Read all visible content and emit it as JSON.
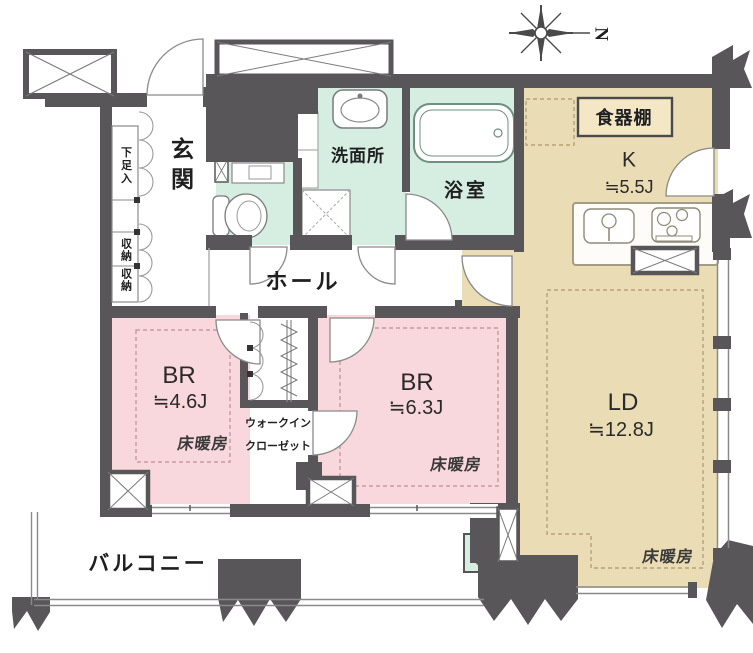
{
  "floor_plan": {
    "compass": {
      "letter": "N"
    },
    "entrance": {
      "label": "玄関",
      "shoe_cabinet": "下足入",
      "storage_upper": "収納",
      "storage_lower": "収納"
    },
    "sanitary": {
      "washroom": "洗面所",
      "bathroom": "浴室"
    },
    "hall": {
      "label": "ホール"
    },
    "kitchen": {
      "label": "K",
      "size": "≒5.5J",
      "cupboard": "食器棚"
    },
    "bedroom1": {
      "label": "BR",
      "size": "≒4.6J",
      "floor_heating": "床暖房"
    },
    "bedroom2": {
      "label": "BR",
      "size": "≒6.3J",
      "floor_heating": "床暖房"
    },
    "walk_in_closet": {
      "line1": "ウォークイン",
      "line2": "クローゼット"
    },
    "living_dining": {
      "label": "LD",
      "size": "≒12.8J",
      "floor_heating": "床暖房"
    },
    "balcony": {
      "label": "バルコニー"
    },
    "colors": {
      "bedroom_floor": "#f8d8dc",
      "living_floor": "#eadcb4",
      "wet_area_floor": "#d5eee1",
      "wall": "#595659"
    }
  }
}
